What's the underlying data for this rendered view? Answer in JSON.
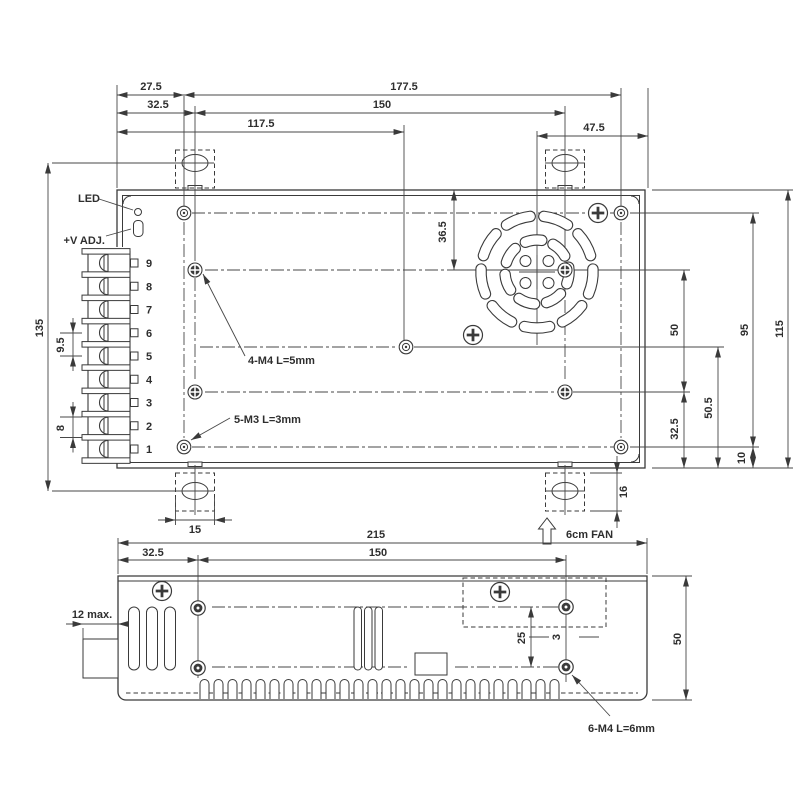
{
  "colors": {
    "line": "#3a3a3a",
    "background": "#ffffff",
    "text": "#2e2e2e"
  },
  "top_view": {
    "dims_top": {
      "left_offset": "27.5",
      "full_right": "177.5",
      "bracket_left": "32.5",
      "bracket_span": "150",
      "center_hole": "117.5",
      "fan_right": "47.5"
    },
    "dims_right": {
      "hole_span": "50",
      "lower": "32.5",
      "lower_mid": "50.5",
      "m3_span": "95",
      "bottom": "10",
      "height": "115"
    },
    "dims_left": {
      "overall": "135",
      "pitch_upper": "9.5",
      "pitch_lower": "8"
    },
    "dims_misc": {
      "fan_top": "36.5",
      "bracket_w": "15",
      "bracket_h": "16"
    },
    "notes": {
      "led": "LED",
      "vadj": "+V ADJ.",
      "m4": "4-M4 L=5mm",
      "m3": "5-M3 L=3mm",
      "fan": "6cm FAN"
    },
    "terminals": [
      "9",
      "8",
      "7",
      "6",
      "5",
      "4",
      "3",
      "2",
      "1"
    ]
  },
  "side_view": {
    "dims": {
      "width": "215",
      "left": "32.5",
      "span": "150",
      "holes": "25",
      "height": "50",
      "protrusion": "12 max.",
      "offset": "3"
    },
    "notes": {
      "m4": "6-M4 L=6mm"
    }
  }
}
